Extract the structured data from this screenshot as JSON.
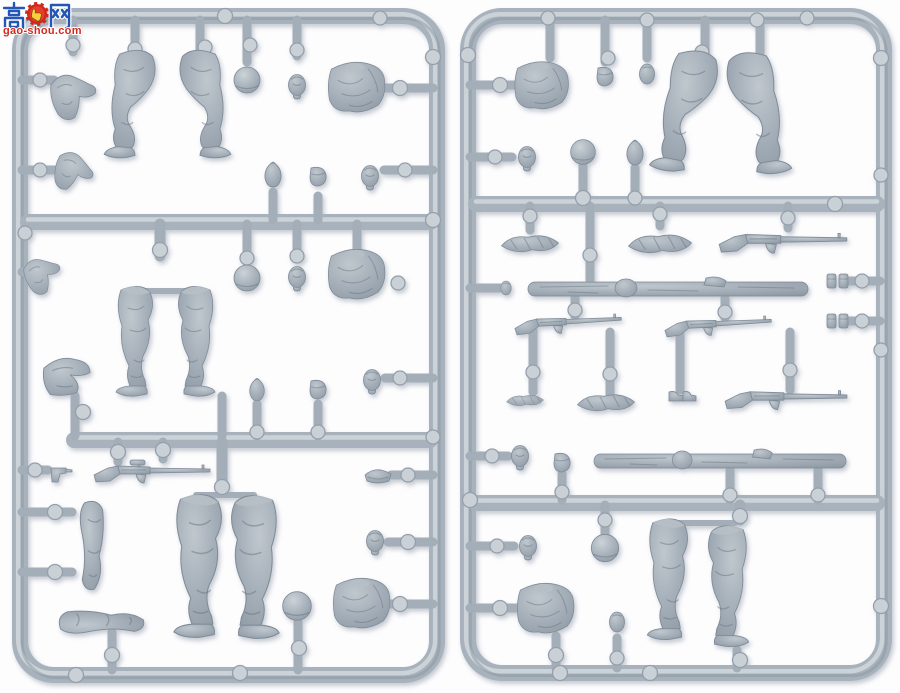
{
  "watermark": {
    "site_name_cn": "高手网",
    "site_url": "gao-shou.com",
    "badge_icon": "thumbs-up-gear-badge",
    "cn_color": "#2457b5",
    "url_color": "#d2291d"
  },
  "colors": {
    "background": "#fdfdfe",
    "plastic_base": "#a8b2bc",
    "plastic_highlight": "#d2d8dd",
    "plastic_shadow": "#86929e",
    "gate_disc": "#c9d0d6"
  },
  "sprues": {
    "left": {
      "label": "figure sprue A",
      "parts": [
        "bent arm x3",
        "straight arm x2",
        "bent legs x2",
        "legs with boots x4",
        "sitting legs",
        "ball helmet x3",
        "head x5",
        "torso x3",
        "canteen x2",
        "ammo pouch x2",
        "scoped rifle",
        "pistol",
        "side cap"
      ]
    },
    "right": {
      "label": "figure sprue B",
      "parts": [
        "torso x2",
        "legs with boots x2",
        "bent legs x2",
        "head x3",
        "ball helmet x2",
        "rolled greatcoat x4",
        "rifle x4",
        "wooden log x2",
        "canteen",
        "grenade x2",
        "ammo pouch x3",
        "pouch pair x2",
        "boots pair"
      ]
    }
  }
}
